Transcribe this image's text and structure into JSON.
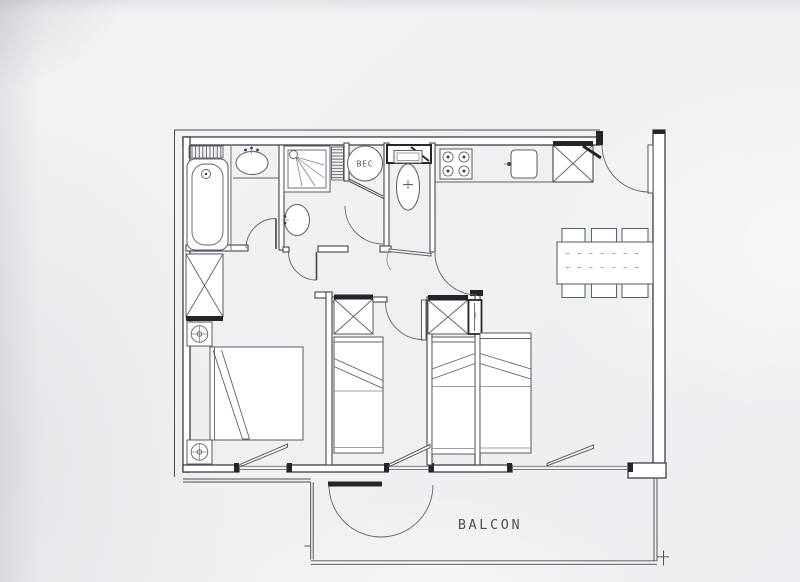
{
  "labels": {
    "balcony": "BALCON",
    "water_heater": "BEC"
  },
  "colors": {
    "paper": "#f0f1f3",
    "wall_line": "#3a3e44",
    "furniture_line": "#5d6269",
    "fixture_black": "#232528",
    "label_text": "#4e5156"
  }
}
